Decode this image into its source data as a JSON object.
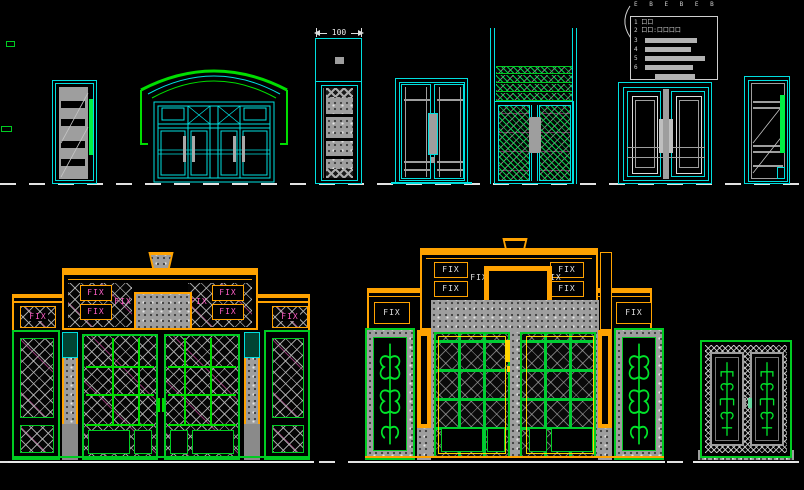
{
  "app": {
    "name": "cad-door-elevations"
  },
  "labels": {
    "fix": "FIX"
  },
  "dimension": {
    "column_width": "100"
  },
  "legend": {
    "header_marks": "E B   E B   E B",
    "rows": [
      {
        "text": "1 口口"
      },
      {
        "text": "2 口口:口口口口"
      },
      {
        "text": "3"
      },
      {
        "text": "4"
      },
      {
        "text": "5"
      },
      {
        "text": "6"
      }
    ]
  },
  "colors": {
    "cyan": "#00DFDF",
    "green": "#00CC22",
    "orange": "#FFA200",
    "yellow": "#FFD400",
    "magenta": "#FF5FC8",
    "gray": "#9E9E9E",
    "white": "#EDEDED",
    "background": "#000000"
  }
}
